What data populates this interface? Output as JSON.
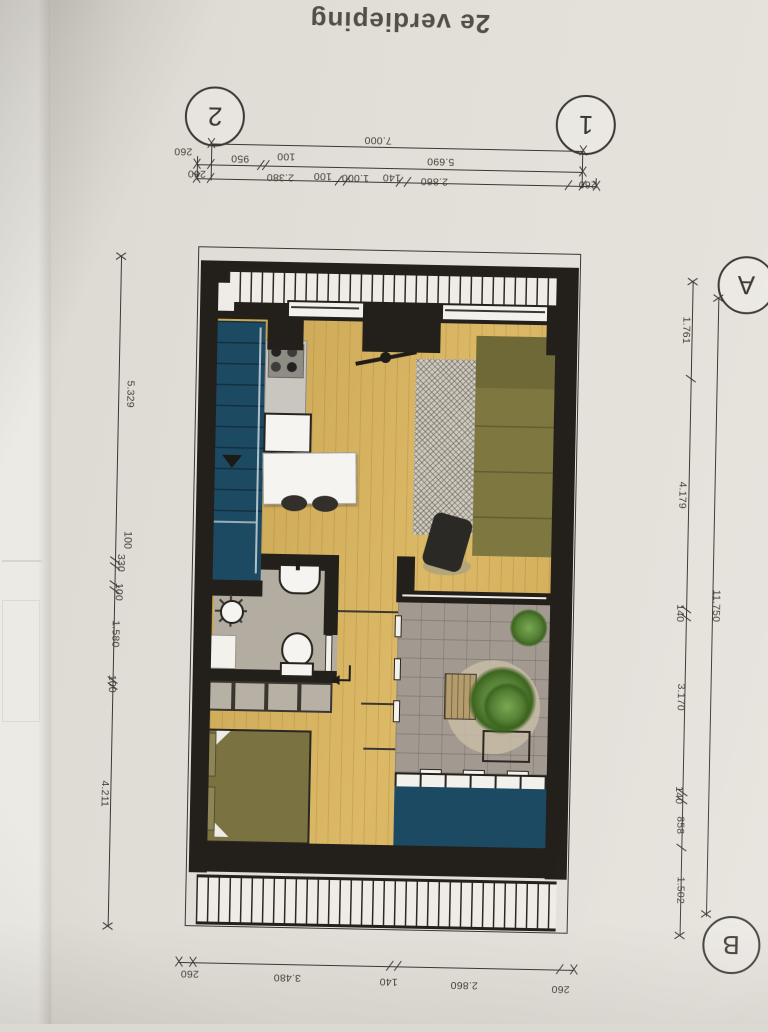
{
  "page": {
    "title": "2e verdieping"
  },
  "grid_markers": {
    "top_left": "2",
    "top_right": "1",
    "right_top": "A",
    "right_bottom": "B"
  },
  "dimensions": {
    "top_total": "7.000",
    "top_row2": [
      "260",
      "950",
      "100",
      "5.690"
    ],
    "top_row3": [
      "260",
      "2.380",
      "100",
      "1.000",
      "140",
      "2.860",
      "260"
    ],
    "bottom_row": [
      "260",
      "3.480",
      "140",
      "2.860",
      "260"
    ],
    "left_chain": [
      "5.329",
      "100",
      "330",
      "100",
      "1.580",
      "100",
      "4.211"
    ],
    "right_chain": [
      "1.761",
      "4.179",
      "140",
      "3.170",
      "140",
      "858",
      "1.502"
    ],
    "right_total": "11.750"
  },
  "colors": {
    "paper": "#e0dcd6",
    "walls": "#23201c",
    "wood_floor": "#d9b35a",
    "stairs_teal": "#1d4a63",
    "void_teal": "#1d4a63",
    "sofa_olive": "#7e7740",
    "sofa_chaise": "#6f6937",
    "bed_olive": "#7a7240",
    "rug_gray": "#cfcabf",
    "bathroom_gray": "#b3aca1",
    "terrace_pavers": "#a29a90",
    "plant_green": "#547f35",
    "island_white": "#f6f4f0"
  }
}
